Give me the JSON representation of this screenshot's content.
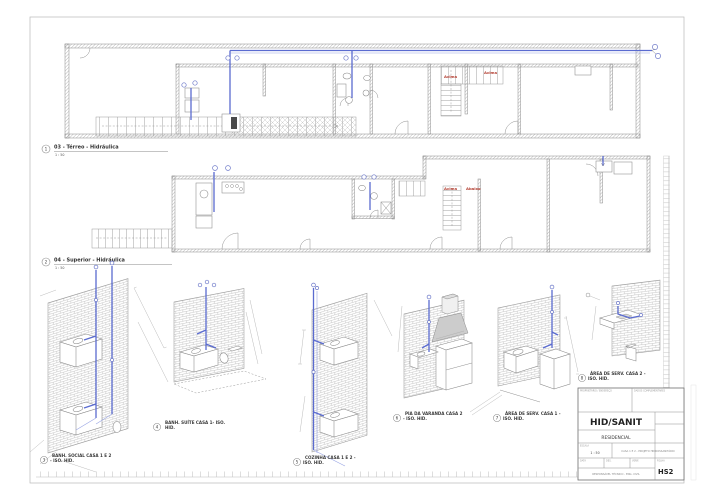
{
  "colors": {
    "pipe_blue": "#5a6bd0",
    "annotation_red": "#b23b2e",
    "line_gray": "#8a8a8a",
    "brick_gray": "#bcbcbc"
  },
  "views": [
    {
      "num": "1",
      "label": "03 - Térreo - Hidráulica",
      "scale": "1 : 50"
    },
    {
      "num": "2",
      "label": "04 - Superior - Hidráulica",
      "scale": "1 : 50"
    },
    {
      "num": "3",
      "line1": "BANH. SOCIAL CASA 1 E 2",
      "line2": "- ISO. HID."
    },
    {
      "num": "4",
      "line1": "BANH. SUÍTE CASA 1- ISO.",
      "line2": "HID."
    },
    {
      "num": "5",
      "line1": "COZINHA CASA 1 E 2 -",
      "line2": "ISO. HID."
    },
    {
      "num": "6",
      "line1": "PIA DA VARANDA CASA 2",
      "line2": "- ISO. HID."
    },
    {
      "num": "7",
      "line1": "ÁREA DE SERV. CASA 1 -",
      "line2": "ISO. HID."
    },
    {
      "num": "8",
      "line1": "ÁREA DE SERV. CASA 2 -",
      "line2": "ISO. HID."
    }
  ],
  "plan_annotations": {
    "terreo_up1": "Acima",
    "terreo_up2": "Acima",
    "superior_up": "Acima",
    "superior_down": "Abaixo"
  },
  "title_block": {
    "field_owner": "PROPRIETÁRIO / ENDEREÇO",
    "field_data": "DADOS COMPLEMENTARES",
    "sheet_title": "HID/SANIT",
    "project": "RESIDENCIAL",
    "scale_label": "ESCALA",
    "scale_value": "1 : 50",
    "project_line": "CASA 1 E 2 - PROJETO HIDROSSANITÁRIO",
    "date_label": "DATA",
    "drawn_label": "DES.",
    "checked_label": "VERIF.",
    "note": "RESPONSÁVEL TÉCNICO - ENG. CIVIL",
    "sheet_label": "FOLHA",
    "sheet_number": "HS2"
  }
}
